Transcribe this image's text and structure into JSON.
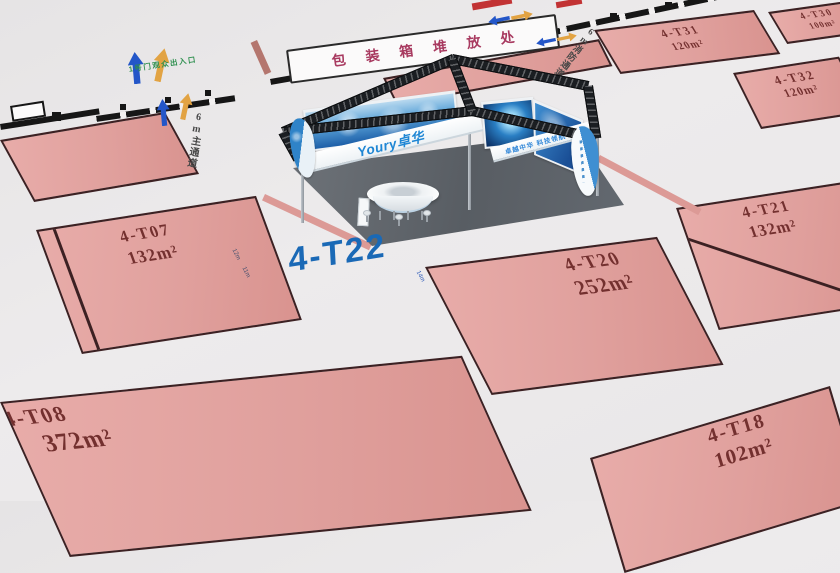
{
  "colors": {
    "accent_blue": "#1a69b6",
    "booth_pink": "#e2a19f",
    "booth_border": "#3c2123",
    "booth_text": "#73302f",
    "wall_black": "#161616",
    "arrow_blue": "#2356c8",
    "arrow_orange": "#e2a343",
    "gate_green": "#2d8f4e",
    "storage_text": "#a83a60"
  },
  "labels": {
    "storage_area": "包装箱堆放处",
    "gate_entrance": "1号门观众出入口",
    "main_aisle": "6m主通道",
    "fire_aisle": "6m消防通道",
    "highlight_booth": "4-T22",
    "dim_12": "12m",
    "dim_11": "11m",
    "dim_14": "14m"
  },
  "booths": [
    {
      "id": "4-T07",
      "area": "132m²"
    },
    {
      "id": "4-T08",
      "area": "372m²"
    },
    {
      "id": "4-T20",
      "area": "252m²"
    },
    {
      "id": "4-T21",
      "area": "132m²"
    },
    {
      "id": "4-T18",
      "area": "102m²"
    },
    {
      "id": "4-T31",
      "area": "120m²"
    },
    {
      "id": "4-T32",
      "area": "120m²"
    },
    {
      "id": "4-T30",
      "area": "100m²"
    }
  ],
  "booth3d": {
    "brand": "Youry卓华",
    "slogan": "卓越中华 科技领航",
    "booth_no": "4-T22"
  }
}
